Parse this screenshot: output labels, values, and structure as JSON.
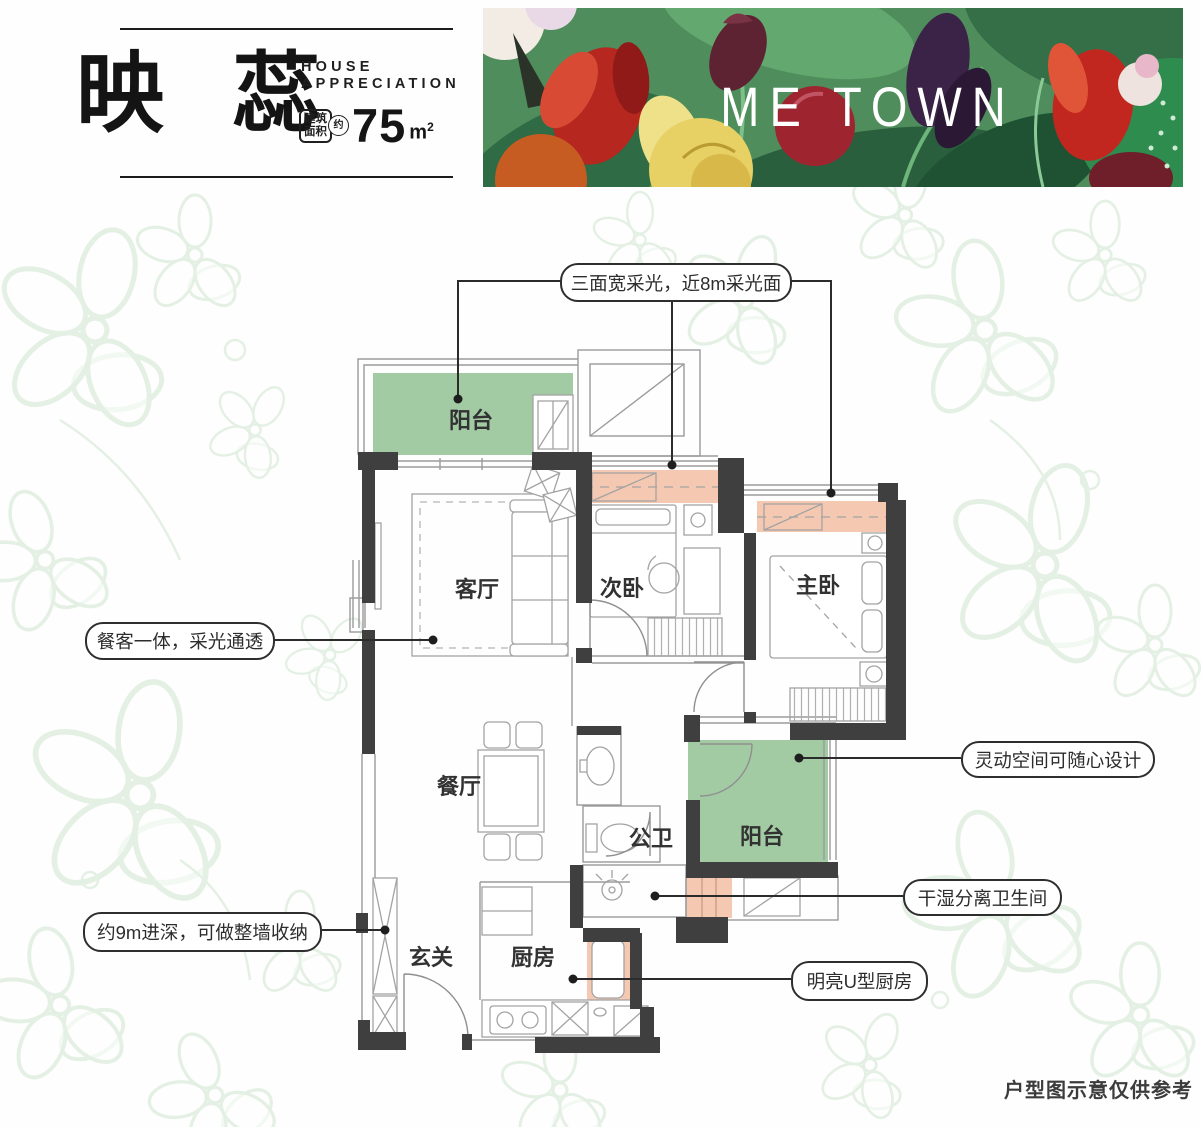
{
  "header": {
    "title": "映 蕊",
    "subtitle_line1": "HOUSE",
    "subtitle_line2": "APPRECIATION",
    "area_label_line1": "建筑",
    "area_label_line2": "面积",
    "area_approx": "约",
    "area_value": "75",
    "area_unit_base": "m",
    "area_unit_sup": "2"
  },
  "banner": {
    "brand": "ME TOWN"
  },
  "rooms": {
    "balcony_top": "阳台",
    "living": "客厅",
    "bedroom2": "次卧",
    "master": "主卧",
    "dining": "餐厅",
    "bath": "公卫",
    "balcony_right": "阳台",
    "foyer": "玄关",
    "kitchen": "厨房"
  },
  "callouts": {
    "light": "三面宽采光，近8m采光面",
    "dining_living": "餐客一体，采光通透",
    "storage": "约9m进深，可做整墙收纳",
    "flex": "灵动空间可随心设计",
    "drywet": "干湿分离卫生间",
    "kitchen_u": "明亮U型厨房"
  },
  "footer": {
    "disclaimer": "户型图示意仅供参考"
  },
  "colors": {
    "balcony_green": "#a2cba4",
    "wardrobe_salmon": "#f5c9b1",
    "wall_dark": "#3f3f3f",
    "callout_line": "#2b2b2b"
  }
}
